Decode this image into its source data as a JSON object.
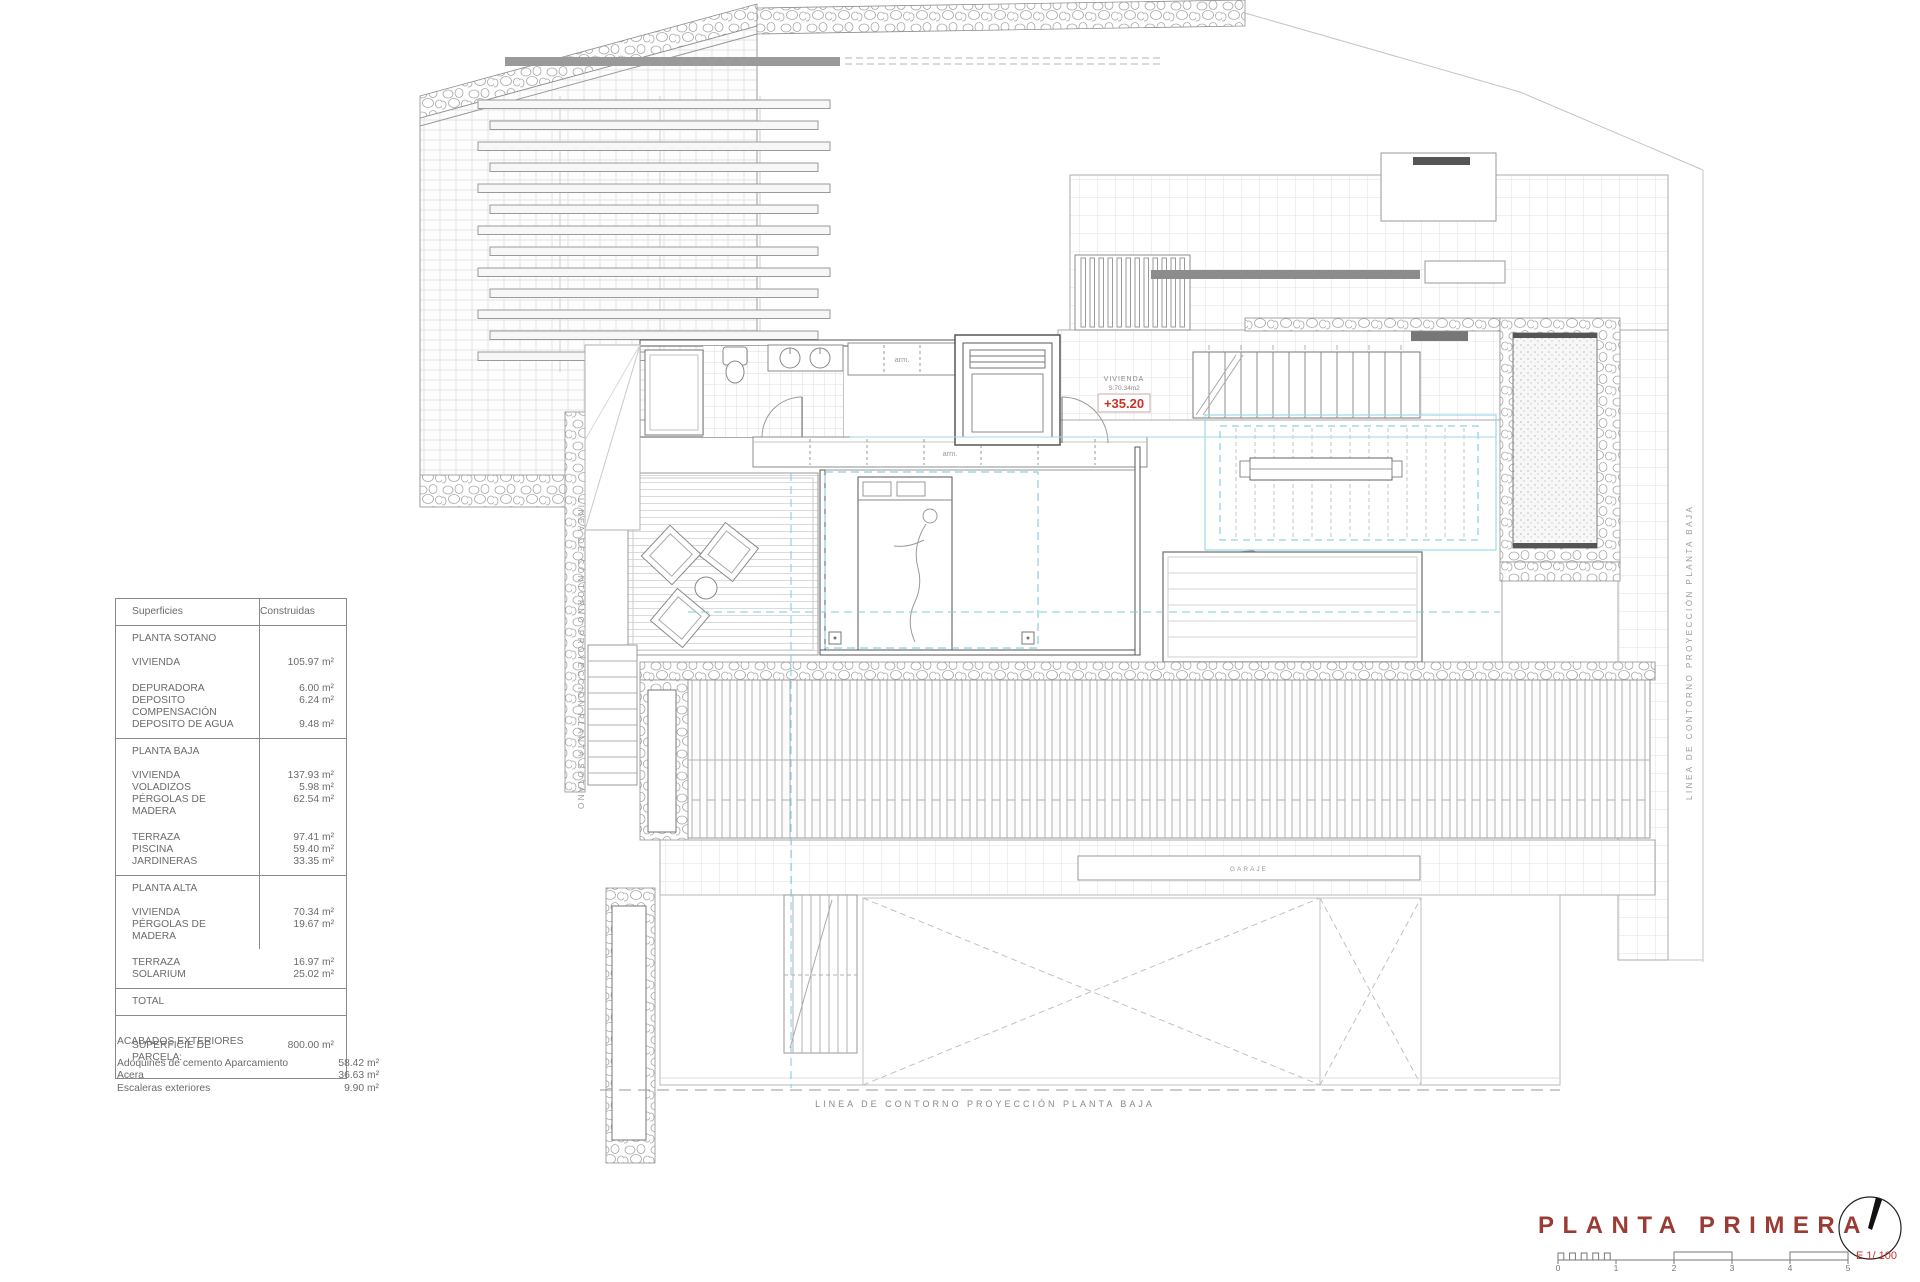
{
  "table": {
    "header": {
      "col1": "Superficies",
      "col2": "Construidas"
    },
    "sections": [
      {
        "title": "PLANTA SOTANO",
        "tall": false,
        "groups": [
          [
            {
              "label": "VIVIENDA",
              "value": "105.97 m²"
            }
          ],
          [
            {
              "label": "DEPURADORA",
              "value": "6.00 m²"
            },
            {
              "label": "DEPOSITO COMPENSACIÓN",
              "value": "6.24 m²"
            },
            {
              "label": "DEPOSITO DE AGUA",
              "value": "9.48 m²"
            }
          ]
        ]
      },
      {
        "title": "PLANTA BAJA",
        "tall": false,
        "groups": [
          [
            {
              "label": "VIVIENDA",
              "value": "137.93 m²"
            },
            {
              "label": "VOLADIZOS",
              "value": "5.98 m²"
            },
            {
              "label": "PÉRGOLAS DE MADERA",
              "value": "62.54 m²"
            }
          ],
          [
            {
              "label": "TERRAZA",
              "value": "97.41 m²"
            },
            {
              "label": "PISCINA",
              "value": "59.40 m²"
            },
            {
              "label": "JARDINERAS",
              "value": "33.35 m²"
            }
          ]
        ]
      },
      {
        "title": "PLANTA ALTA",
        "tall": false,
        "groups": [
          [
            {
              "label": "VIVIENDA",
              "value": "70.34 m²"
            },
            {
              "label": "PÉRGOLAS DE MADERA",
              "value": "19.67 m²"
            }
          ],
          [
            {
              "label": "TERRAZA",
              "value": "16.97 m²"
            },
            {
              "label": "SOLARIUM",
              "value": "25.02 m²"
            }
          ]
        ]
      },
      {
        "title": "TOTAL",
        "tall": false,
        "groups": []
      },
      {
        "title": "",
        "tall": true,
        "groups": [
          [
            {
              "label": "SUPERFICIE DE PARCELA:",
              "value": "800.00 m²"
            }
          ]
        ]
      }
    ]
  },
  "acabados": {
    "title": "ACABADOS EXTERIORES",
    "rows": [
      {
        "label": "Adoquines de cemento Aparcamiento",
        "value": "58.42 m²"
      },
      {
        "label": "Acera",
        "value": "36.63 m²"
      },
      {
        "label": "Escaleras exteriores",
        "value": "9.90 m²"
      }
    ]
  },
  "plan": {
    "level_badge": {
      "line1": "VIVIENDA",
      "line2": "S:70.34m2",
      "value": "+35.20"
    },
    "labels": {
      "contour_left": "LINEA DE CONTORNO PROYECCIÓN PLANTA SOTANO",
      "contour_right": "LINEA DE CONTORNO PROYECCIÓN PLANTA BAJA",
      "contour_bottom": "LINEA DE CONTORNO PROYECCIÓN PLANTA BAJA",
      "wardrobe1": "arm.",
      "wardrobe2": "arm.",
      "garage": "GARAJE"
    }
  },
  "titleblock": {
    "title": "PLANTA PRIMERA",
    "scale_label": "E 1/ 100",
    "ticks": [
      "0",
      "1",
      "2",
      "3",
      "4",
      "5"
    ]
  },
  "colors": {
    "accent_red": "#cc3128",
    "title_maroon": "#9a3c33",
    "cyan_dash": "#6fc6dd",
    "cyan_light": "#9ed8e6",
    "line_gray": "#9a9a9a"
  }
}
